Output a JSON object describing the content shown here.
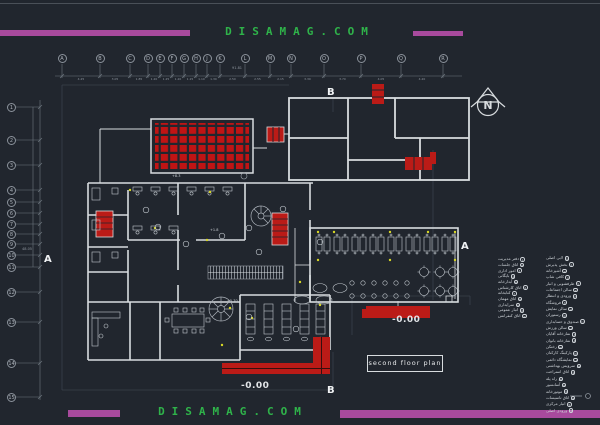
{
  "watermark": {
    "top": "DISAMAG.COM",
    "bottom": "DISAMAG.COM"
  },
  "grid": {
    "columns": [
      "A",
      "B",
      "C",
      "D",
      "E",
      "F",
      "G",
      "H",
      "J",
      "K",
      "L",
      "M",
      "N",
      "O",
      "P",
      "Q",
      "R"
    ],
    "rows": [
      "1",
      "2",
      "3",
      "4",
      "5",
      "6",
      "7",
      "8",
      "9",
      "10",
      "11",
      "12",
      "13",
      "14",
      "15"
    ],
    "total_dim": "91.81",
    "left_dim": "48.05",
    "col_dims": [
      "4.25",
      "3.05",
      "1.85",
      "1.20",
      "1.25",
      "1.20",
      "1.15",
      "1.10",
      "1.30",
      "2.50",
      "2.55",
      "2.15",
      "3.30",
      "3.70",
      "4.05",
      "4.20"
    ]
  },
  "north": {
    "label": "N"
  },
  "sections": {
    "a_left": "A",
    "a_right": "A",
    "b_top": "B",
    "b_bottom": "B"
  },
  "levels": {
    "hall": "+1.8",
    "roof": "+8.3",
    "stair": "+5.70",
    "right": "-0.00",
    "bottom": "-0.00"
  },
  "title_box": {
    "label": "second floor plan"
  },
  "legend": {
    "col_left": [
      {
        "num": "1",
        "label": "دفتر مدیریت"
      },
      {
        "num": "2",
        "label": "اتاق جلسات"
      },
      {
        "num": "3",
        "label": "امور اداری"
      },
      {
        "num": "4",
        "label": "بایگانی"
      },
      {
        "num": "5",
        "label": "آبدارخانه"
      },
      {
        "num": "6",
        "label": "اتاق کارشناس"
      },
      {
        "num": "7",
        "label": "کتابخانه"
      },
      {
        "num": "8",
        "label": "اتاق مهمان"
      },
      {
        "num": "9",
        "label": "سرایداری"
      },
      {
        "num": "10",
        "label": "انبار عمومی"
      },
      {
        "num": "11",
        "label": "اتاق کنفرانس"
      }
    ],
    "col_right": [
      {
        "num": "1",
        "label": "لابی اصلی"
      },
      {
        "num": "2",
        "label": "بخش پذیرش"
      },
      {
        "num": "3",
        "label": "آشپزخانه"
      },
      {
        "num": "4",
        "label": "کافی شاپ"
      },
      {
        "num": "5",
        "label": "ظرفشویی و انبار"
      },
      {
        "num": "6",
        "label": "سالن اجتماعات"
      },
      {
        "num": "7",
        "label": "ورودی و انتظار"
      },
      {
        "num": "8",
        "label": "فروشگاه"
      },
      {
        "num": "9",
        "label": "سالن نمایش"
      },
      {
        "num": "10",
        "label": "رستوران"
      },
      {
        "num": "11",
        "label": "صندوق و حسابداری"
      },
      {
        "num": "12",
        "label": "سالن ورزش"
      },
      {
        "num": "13",
        "label": "نمازخانه آقایان"
      },
      {
        "num": "14",
        "label": "نمازخانه بانوان"
      },
      {
        "num": "15",
        "label": "رختکن"
      },
      {
        "num": "16",
        "label": "پارکینگ کارکنان"
      },
      {
        "num": "17",
        "label": "نمایشگاه دائمی"
      },
      {
        "num": "18",
        "label": "سرویس بهداشتی"
      },
      {
        "num": "19",
        "label": "اتاق استراحت"
      },
      {
        "num": "20",
        "label": "راه پله"
      },
      {
        "num": "21",
        "label": "آسانسور"
      },
      {
        "num": "22",
        "label": "موتورخانه"
      },
      {
        "num": "23",
        "label": "اتاق تاسیسات"
      },
      {
        "num": "24",
        "label": "انبار مرکزی"
      },
      {
        "num": "25",
        "label": "ورودی اصلی"
      }
    ]
  },
  "colors": {
    "background": "#21262e",
    "magenta_bar": "#a84a9d",
    "watermark_green": "#2fb34a",
    "wall_white": "#d8dcdf",
    "cad_red": "#bb1b17",
    "dim_gray": "#8e959e",
    "dot_yellow": "#d8d826"
  }
}
